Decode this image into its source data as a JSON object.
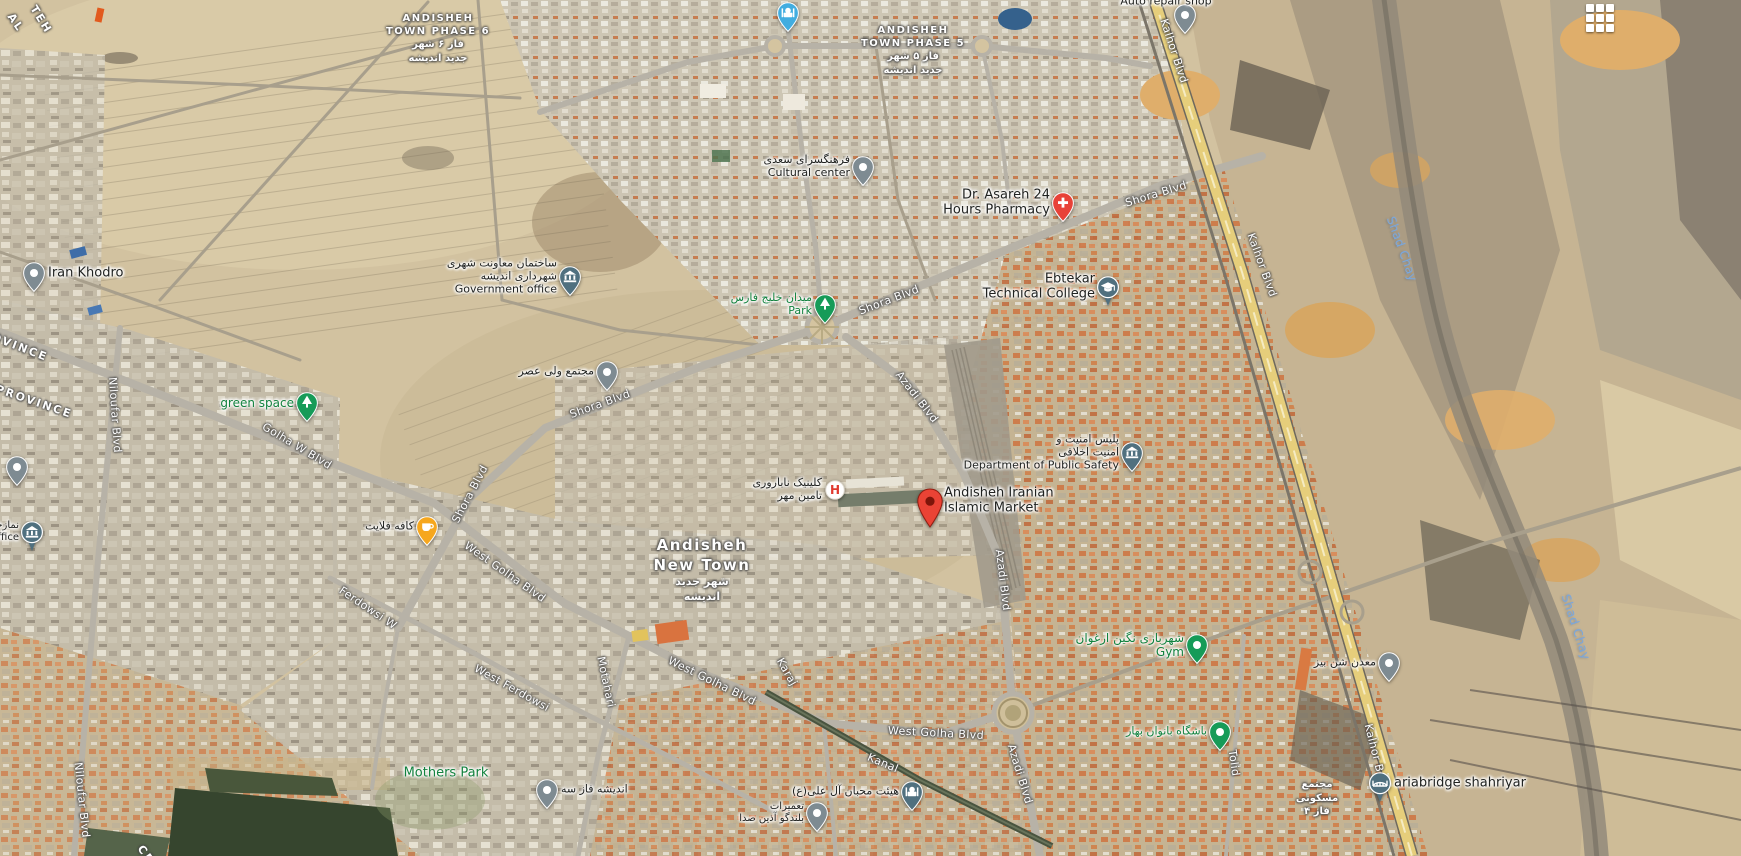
{
  "map": {
    "type": "satellite",
    "controls": {
      "apps_grid_icon": "grid-3x3"
    },
    "colors": {
      "pin_gray": "#7e8b92",
      "pin_blue": "#42ade0",
      "pin_slate": "#50707f",
      "pin_green": "#169b58",
      "pin_amber": "#f6a71e",
      "pin_red": "#e84238",
      "marker_red": "#ea4335",
      "marker_inner": "#7e150a",
      "label_dark": "#202220",
      "label_green": "#12823e",
      "label_water": "#7aa7dc",
      "highway_yellow": "#e6ce7b"
    },
    "area_labels": [
      {
        "id": "town-phase-6",
        "x": 438,
        "y": 12,
        "size": 10,
        "fa_size": 10,
        "lines": [
          "ANDISHEH",
          "TOWN PHASE 6"
        ],
        "fa_lines": [
          "فاز ۶ شهر",
          "جدید اندیشه"
        ]
      },
      {
        "id": "town-phase-5",
        "x": 913,
        "y": 24,
        "size": 10,
        "fa_size": 10,
        "lines": [
          "ANDISHEH",
          "TOWN PHASE 5"
        ],
        "fa_lines": [
          "فاز ۵ شهر",
          "جدید اندیشه"
        ]
      },
      {
        "id": "andisheh-new-town",
        "x": 702,
        "y": 536,
        "size": 15,
        "fa_size": 11,
        "lines": [
          "Andisheh",
          "New Town"
        ],
        "fa_lines": [
          "شهر جدید",
          "اندیشه"
        ]
      },
      {
        "id": "residential-complex",
        "x": 1317,
        "y": 778,
        "size": 10,
        "fa_size": 10,
        "lines": [],
        "fa_lines": [
          "مجتمع",
          "مسکونی",
          "فاز ۴"
        ]
      }
    ],
    "province_labels": [
      {
        "text": "AL",
        "x": 10,
        "y": 8,
        "rot": 55
      },
      {
        "text": "TEH",
        "x": 33,
        "y": 0,
        "rot": 58
      },
      {
        "text": "OVINCE",
        "x": -8,
        "y": 330,
        "rot": 21
      },
      {
        "text": "PROVINCE",
        "x": -4,
        "y": 382,
        "rot": 19
      },
      {
        "text": "CE",
        "x": 140,
        "y": 840,
        "rot": 55
      }
    ],
    "road_labels": [
      {
        "text": "Shora Blvd",
        "x": 1156,
        "y": 194,
        "rot": -17
      },
      {
        "text": "Shora Blvd",
        "x": 889,
        "y": 300,
        "rot": -21
      },
      {
        "text": "Shora Blvd",
        "x": 600,
        "y": 404,
        "rot": -20
      },
      {
        "text": "Shora Blvd",
        "x": 470,
        "y": 494,
        "rot": -62
      },
      {
        "text": "Azadi Blvd",
        "x": 917,
        "y": 397,
        "rot": 52
      },
      {
        "text": "Azadi Blvd",
        "x": 1003,
        "y": 580,
        "rot": 83
      },
      {
        "text": "Azadi Blvd",
        "x": 1020,
        "y": 774,
        "rot": 73
      },
      {
        "text": "Kalhor Blvd",
        "x": 1174,
        "y": 51,
        "rot": 72
      },
      {
        "text": "Kalhor Blvd",
        "x": 1262,
        "y": 265,
        "rot": 70
      },
      {
        "text": "Kalhor B",
        "x": 1374,
        "y": 748,
        "rot": 76
      },
      {
        "text": "Golha W Blvd",
        "x": 297,
        "y": 446,
        "rot": 31
      },
      {
        "text": "West Golha Blvd",
        "x": 505,
        "y": 572,
        "rot": 35
      },
      {
        "text": "West Golha Blvd",
        "x": 712,
        "y": 681,
        "rot": 26
      },
      {
        "text": "West Golha Blvd",
        "x": 936,
        "y": 733,
        "rot": 3
      },
      {
        "text": "West Ferdowsi",
        "x": 512,
        "y": 688,
        "rot": 29
      },
      {
        "text": "Ferdowsi W",
        "x": 368,
        "y": 608,
        "rot": 34
      },
      {
        "text": "Motahari",
        "x": 606,
        "y": 682,
        "rot": 78
      },
      {
        "text": "Niloufar Blvd",
        "x": 115,
        "y": 415,
        "rot": 86
      },
      {
        "text": "Niloufar Blvd",
        "x": 82,
        "y": 800,
        "rot": 84
      },
      {
        "text": "Kanal",
        "x": 883,
        "y": 763,
        "rot": 23
      },
      {
        "text": "Karaj",
        "x": 787,
        "y": 672,
        "rot": 60
      },
      {
        "text": "Tolid",
        "x": 1234,
        "y": 763,
        "rot": 82
      },
      {
        "text": "Shad Chay",
        "x": 1402,
        "y": 249,
        "rot": 70,
        "water": true
      },
      {
        "text": "Shad Chay",
        "x": 1576,
        "y": 627,
        "rot": 72,
        "water": true
      }
    ],
    "pois": [
      {
        "id": "iran-khodro",
        "pin": "dot",
        "x": 34,
        "y": 273,
        "label": {
          "side": "right",
          "color": "dark",
          "size": 13,
          "lines": [
            "Iran Khodro"
          ]
        }
      },
      {
        "id": "mosque-north",
        "pin": "mosque",
        "x": 788,
        "y": 13
      },
      {
        "id": "auto-repair-shop",
        "pin": "dot",
        "x": 1185,
        "y": 15,
        "label": {
          "side": "custom",
          "dx": -19,
          "dy": -13,
          "color": "dark",
          "size": 11,
          "lines": [
            "Auto repair shop"
          ]
        }
      },
      {
        "id": "cultural-center",
        "pin": "dot",
        "x": 863,
        "y": 167,
        "label": {
          "side": "left",
          "color": "dark",
          "size": 11,
          "fa_lines": [
            "فرهنگسرای سعدی"
          ],
          "lines": [
            "Cultural center"
          ]
        }
      },
      {
        "id": "government-office",
        "pin": "bank",
        "x": 570,
        "y": 277,
        "label": {
          "side": "left",
          "color": "dark",
          "size": 11,
          "fa_lines": [
            "ساختمان معاونت شهری",
            "شهرداری اندیشه"
          ],
          "lines": [
            "Government office"
          ]
        }
      },
      {
        "id": "asareh-pharmacy",
        "pin": "pharmacy",
        "x": 1063,
        "y": 203,
        "label": {
          "side": "left",
          "color": "dark",
          "size": 13,
          "lines": [
            "Dr. Asareh 24",
            "Hours Pharmacy"
          ]
        }
      },
      {
        "id": "ebtekar-college",
        "pin": "school",
        "x": 1108,
        "y": 287,
        "label": {
          "side": "left",
          "color": "dark",
          "size": 13,
          "lines": [
            "Ebtekar",
            "Technical College"
          ]
        }
      },
      {
        "id": "khalij-fars-park",
        "pin": "tree",
        "x": 825,
        "y": 305,
        "label": {
          "side": "left",
          "color": "green",
          "size": 11,
          "fa_lines": [
            "میدان خلیج فارس"
          ],
          "lines": [
            "Park"
          ]
        }
      },
      {
        "id": "green-space",
        "pin": "tree",
        "x": 307,
        "y": 403,
        "label": {
          "side": "left",
          "color": "green",
          "size": 12,
          "lines": [
            "green space"
          ]
        }
      },
      {
        "id": "vali-asr-complex",
        "pin": "dot",
        "x": 607,
        "y": 372,
        "label": {
          "side": "left",
          "color": "dark",
          "size": 11,
          "fa_lines": [
            "مجتمع ولی عصر"
          ]
        }
      },
      {
        "id": "public-safety",
        "pin": "bank",
        "x": 1132,
        "y": 453,
        "label": {
          "side": "left",
          "color": "dark",
          "size": 11,
          "fa_lines": [
            "پلیس امنیت و",
            "امنیت اخلاقی"
          ],
          "lines": [
            "Department of Public Safety"
          ]
        }
      },
      {
        "id": "islamic-market",
        "pin": "destination",
        "x": 930,
        "y": 501,
        "label": {
          "side": "right",
          "color": "dark",
          "size": 13,
          "lines": [
            "Andisheh Iranian",
            "Islamic Market"
          ]
        }
      },
      {
        "id": "infertility-clinic",
        "pin": "hospital",
        "x": 835,
        "y": 490,
        "label": {
          "side": "left",
          "color": "dark",
          "size": 11,
          "fa_lines": [
            "کلینیک ناباروری",
            "تامین مهر"
          ]
        }
      },
      {
        "id": "cafe-flight",
        "pin": "cafe",
        "x": 427,
        "y": 527,
        "label": {
          "side": "left",
          "color": "dark",
          "size": 11,
          "fa_lines": [
            "کافه فلایت"
          ]
        }
      },
      {
        "id": "poi-left-edge",
        "pin": "dot",
        "x": 17,
        "y": 467
      },
      {
        "id": "office-left-edge",
        "pin": "bank-circle",
        "x": 32,
        "y": 532,
        "label": {
          "side": "left",
          "color": "dark",
          "size": 10,
          "fa_lines": [
            "نمازخانه"
          ],
          "lines": [
            "ffice"
          ]
        }
      },
      {
        "id": "gym",
        "pin": "green-dot",
        "x": 1197,
        "y": 645,
        "label": {
          "side": "left",
          "color": "green",
          "size": 12,
          "fa_lines": [
            "شهربازی نگین ارغوان"
          ],
          "lines": [
            "Gym"
          ]
        }
      },
      {
        "id": "banovan-bahar-club",
        "pin": "green-dot",
        "x": 1220,
        "y": 732,
        "label": {
          "side": "left",
          "color": "green",
          "size": 11,
          "fa_lines": [
            "باشگاه بانوان بهار"
          ]
        }
      },
      {
        "id": "andisheh-phase-3",
        "pin": "dot",
        "x": 547,
        "y": 790,
        "label": {
          "side": "right",
          "color": "dark",
          "size": 11,
          "fa_lines": [
            "اندیشه فاز سه"
          ]
        }
      },
      {
        "id": "mohebban-ali-heyat",
        "pin": "mosque-dark",
        "x": 912,
        "y": 792,
        "label": {
          "side": "left",
          "color": "dark",
          "size": 11,
          "fa_lines": [
            "هیئت محبان آل علی(ع)"
          ]
        }
      },
      {
        "id": "speaker-repair",
        "pin": "dot",
        "x": 817,
        "y": 813,
        "label": {
          "side": "left",
          "color": "dark",
          "size": 10,
          "fa_lines": [
            "تعمیرات",
            "بلندگو آذین صدا"
          ]
        }
      },
      {
        "id": "sand-mine",
        "pin": "dot",
        "x": 1389,
        "y": 663,
        "label": {
          "side": "left",
          "color": "dark",
          "size": 11,
          "fa_lines": [
            "معدن شن بیز"
          ]
        }
      },
      {
        "id": "ariabridge-shahriyar",
        "pin": "bridge",
        "x": 1380,
        "y": 783,
        "label": {
          "side": "right",
          "color": "dark",
          "size": 13,
          "lines": [
            "ariabridge shahriyar"
          ]
        }
      },
      {
        "id": "mothers-park",
        "pin": "none",
        "x": 446,
        "y": 773,
        "label": {
          "side": "center",
          "color": "green",
          "size": 13,
          "lines": [
            "Mothers Park"
          ]
        }
      }
    ]
  }
}
